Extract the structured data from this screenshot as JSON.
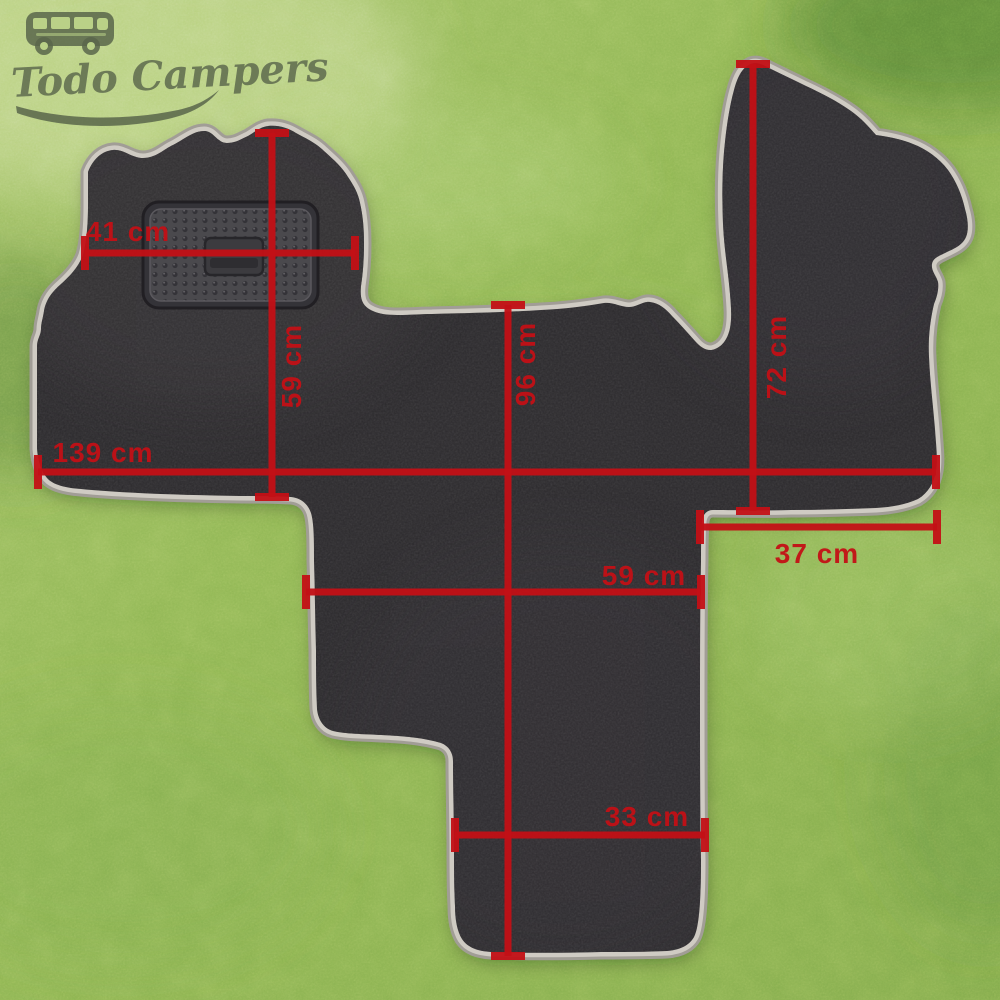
{
  "canvas": {
    "width": 1000,
    "height": 1000
  },
  "logo": {
    "brand": "Todo Campers",
    "icon": "camper-van-icon"
  },
  "product": {
    "description": "van cab floor mat with heel pad laid on artificial grass"
  },
  "measurements": {
    "unit": "cm",
    "color": "#c31016",
    "vertical": [
      {
        "value": 59,
        "label": "59 cm",
        "x": 272,
        "y1": 133,
        "y2": 497,
        "lx": 301,
        "ly": 366
      },
      {
        "value": 96,
        "label": "96 cm",
        "x": 508,
        "y1": 305,
        "y2": 956,
        "lx": 535,
        "ly": 364
      },
      {
        "value": 72,
        "label": "72 cm",
        "x": 753,
        "y1": 64,
        "y2": 511,
        "lx": 786,
        "ly": 357
      }
    ],
    "horizontal": [
      {
        "value": 41,
        "label": "41 cm",
        "y": 253,
        "x1": 85,
        "x2": 355,
        "lx": 128,
        "ly": 241
      },
      {
        "value": 139,
        "label": "139 cm",
        "y": 472,
        "x1": 38,
        "x2": 936,
        "lx": 103,
        "ly": 462
      },
      {
        "value": 37,
        "label": "37 cm",
        "y": 527,
        "x1": 700,
        "x2": 937,
        "lx": 817,
        "ly": 563
      },
      {
        "value": 59,
        "label": "59 cm",
        "y": 592,
        "x1": 306,
        "x2": 701,
        "lx": 644,
        "ly": 585
      },
      {
        "value": 33,
        "label": "33 cm",
        "y": 835,
        "x1": 455,
        "x2": 705,
        "lx": 647,
        "ly": 826
      }
    ]
  },
  "colors": {
    "grass_base": "#8fb553",
    "grass_light": "#c6d893",
    "grass_dark": "#4d7c33",
    "mat": "#2c2a2d",
    "trim": "#cfcbc3",
    "trim_shadow": "#a19d96",
    "heel_pad": "#4a494d",
    "measure": "#c31016",
    "logo": "#48523f"
  }
}
